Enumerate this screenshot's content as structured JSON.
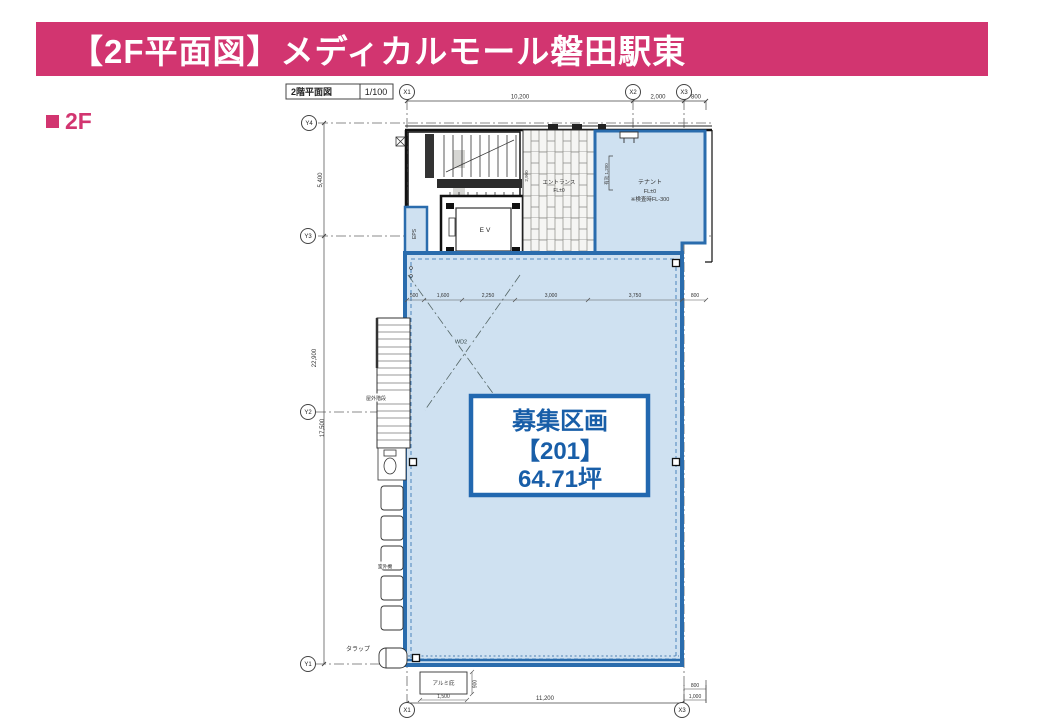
{
  "header": {
    "title": "【2F平面図】メディカルモール磐田駅東"
  },
  "floor_badge": {
    "label": "2F"
  },
  "drawing": {
    "title_block": {
      "title": "2階平面図",
      "scale": "1/100"
    },
    "grid": {
      "x1": "X1",
      "x2": "X2",
      "x3": "X3",
      "y1": "Y1",
      "y2": "Y2",
      "y3": "Y3",
      "y4": "Y4"
    },
    "dims": {
      "top_span": "10,200",
      "top_span2": "2,000",
      "top_span3": "800",
      "left_upper": "5,400",
      "left_total": "22,900",
      "left_lower": "17,500",
      "interior": [
        "500",
        "1,600",
        "2,250",
        "3,000",
        "3,750",
        "800"
      ],
      "entrance_depth": "2,900",
      "tenant_clear": "有効 1,200",
      "bottom_total": "11,200",
      "canopy_width": "1,500",
      "canopy_depth": "900",
      "bottom_right_a": "800",
      "bottom_right_b": "1,000"
    },
    "labels": {
      "eps": "EPS",
      "elevator": "EV",
      "entrance": "エントランス",
      "entrance_level": "FL±0",
      "tenant": "テナント",
      "tenant_level": "FL±0",
      "tenant_note": "※検査時FL-300",
      "outdoor_stair": "屋外階段",
      "outdoor_unit": "室外機",
      "ladder": "タラップ",
      "canopy": "アルミ庇",
      "door_tag": "WD2"
    },
    "highlight": {
      "line1": "募集区画",
      "line2": "【201】",
      "line3": "64.71坪"
    }
  },
  "colors": {
    "accent": "#d23570",
    "plan_blue": "#2a6cad",
    "plan_fill": "#cfe1f1",
    "highlight_text": "#185ea8"
  }
}
